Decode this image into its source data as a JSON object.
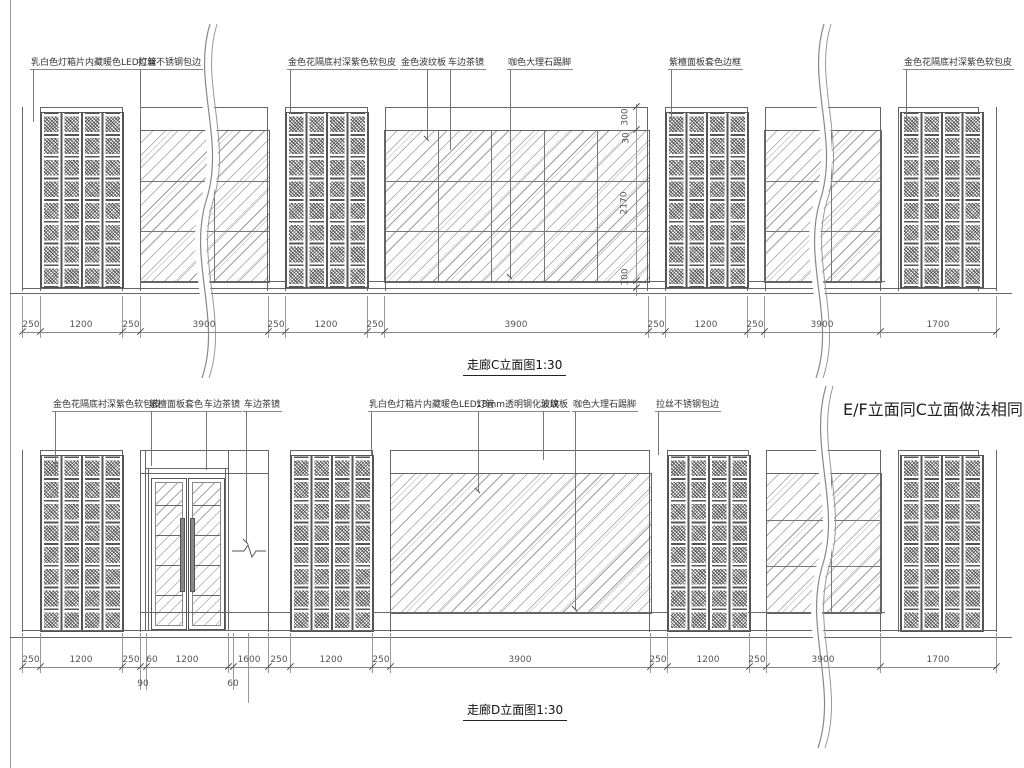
{
  "drawing_c": {
    "title": "走廊C立面图1:30",
    "callouts": [
      "乳白色灯箱片内藏暖色LED灯管",
      "拉丝不锈钢包边",
      "金色花隔底衬深紫色软包皮",
      "金色波纹板",
      "车边茶镜",
      "咖色大理石踢脚",
      "紫檀面板套色边框",
      "金色花隔底衬深紫色软包皮"
    ],
    "dims": [
      "250",
      "1200",
      "250",
      "3900",
      "250",
      "1200",
      "250",
      "3900",
      "250",
      "1200",
      "250",
      "3900",
      "1700"
    ],
    "vdims": [
      "300",
      "30",
      "2170",
      "100"
    ]
  },
  "drawing_d": {
    "title": "走廊D立面图1:30",
    "note": "E/F立面同C立面做法相同",
    "callouts": [
      "金色花隔底衬深紫色软包皮",
      "紫檀面板套色",
      "车边茶镜",
      "车边茶镜",
      "乳白色灯箱片内藏暖色LED灯管",
      "18mm透明钢化玻璃",
      "波纹板",
      "咖色大理石踢脚",
      "拉丝不锈钢包边"
    ],
    "dims": [
      "250",
      "1200",
      "250",
      "60",
      "1200",
      "1600",
      "250",
      "1200",
      "250",
      "3900",
      "250",
      "1200",
      "250",
      "3900",
      "1700"
    ],
    "sub_dims": [
      "90",
      "60"
    ]
  }
}
